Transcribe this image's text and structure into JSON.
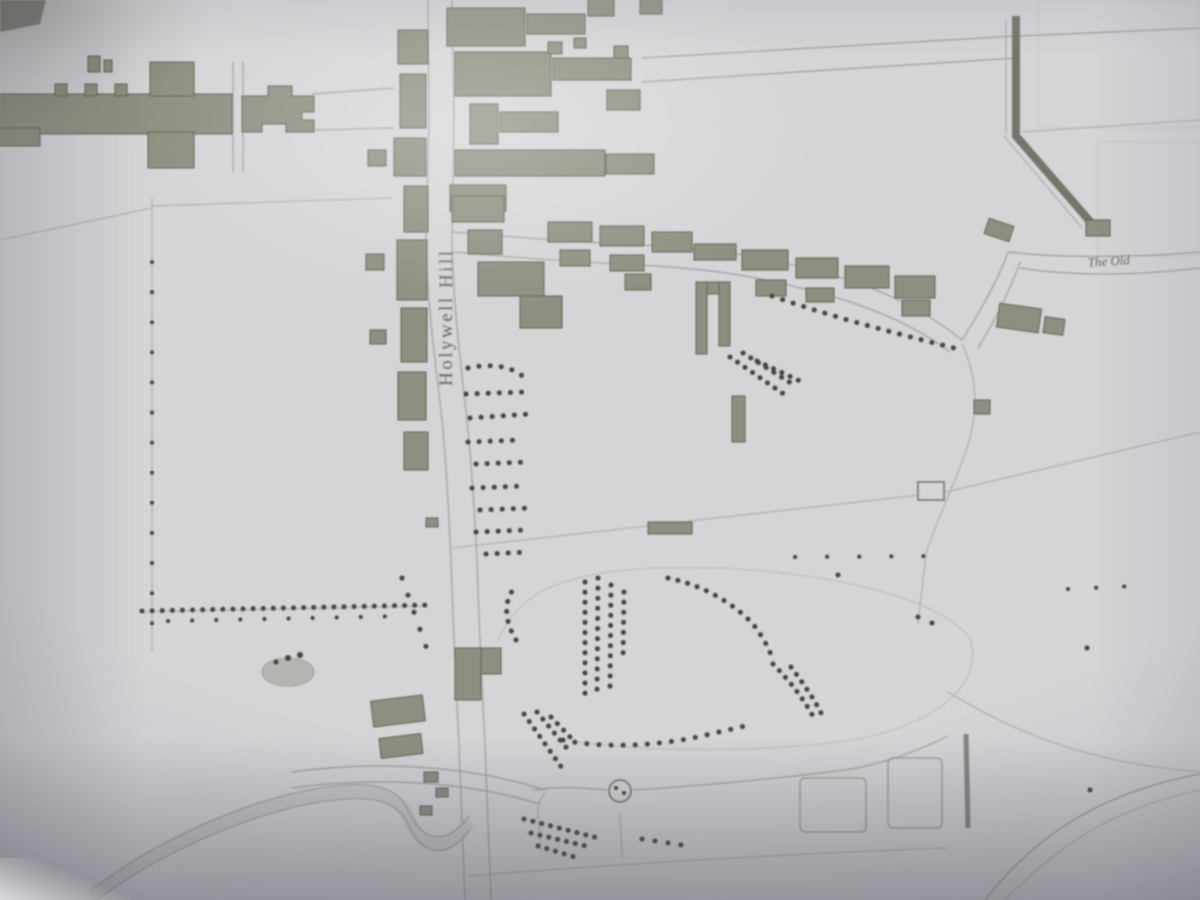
{
  "labels": {
    "street": "Holywell Hill",
    "right_partial": "The Old"
  },
  "colors": {
    "paper": "#d5d4d7",
    "paper_bright": "#e4e3e6",
    "building": "#8d8f80",
    "building_outline": "#5c5e52",
    "tree": "#45473c",
    "faint_line": "#adaca7",
    "plot_line": "#9b9a95",
    "water_edge": "#8f8e89",
    "water_bed": "#c7c6c9",
    "label_ink": "#55544d",
    "vignette_shadow": "#63636e"
  },
  "features": [
    "abbey-church",
    "holywell-hill-street",
    "high-street-block",
    "street-west-frontage",
    "street-east-frontage",
    "lane-buildings",
    "outlying-buildings",
    "orchard-trees",
    "park-tree-belt",
    "hedgerow",
    "stream",
    "walled-garden",
    "field-plots"
  ]
}
